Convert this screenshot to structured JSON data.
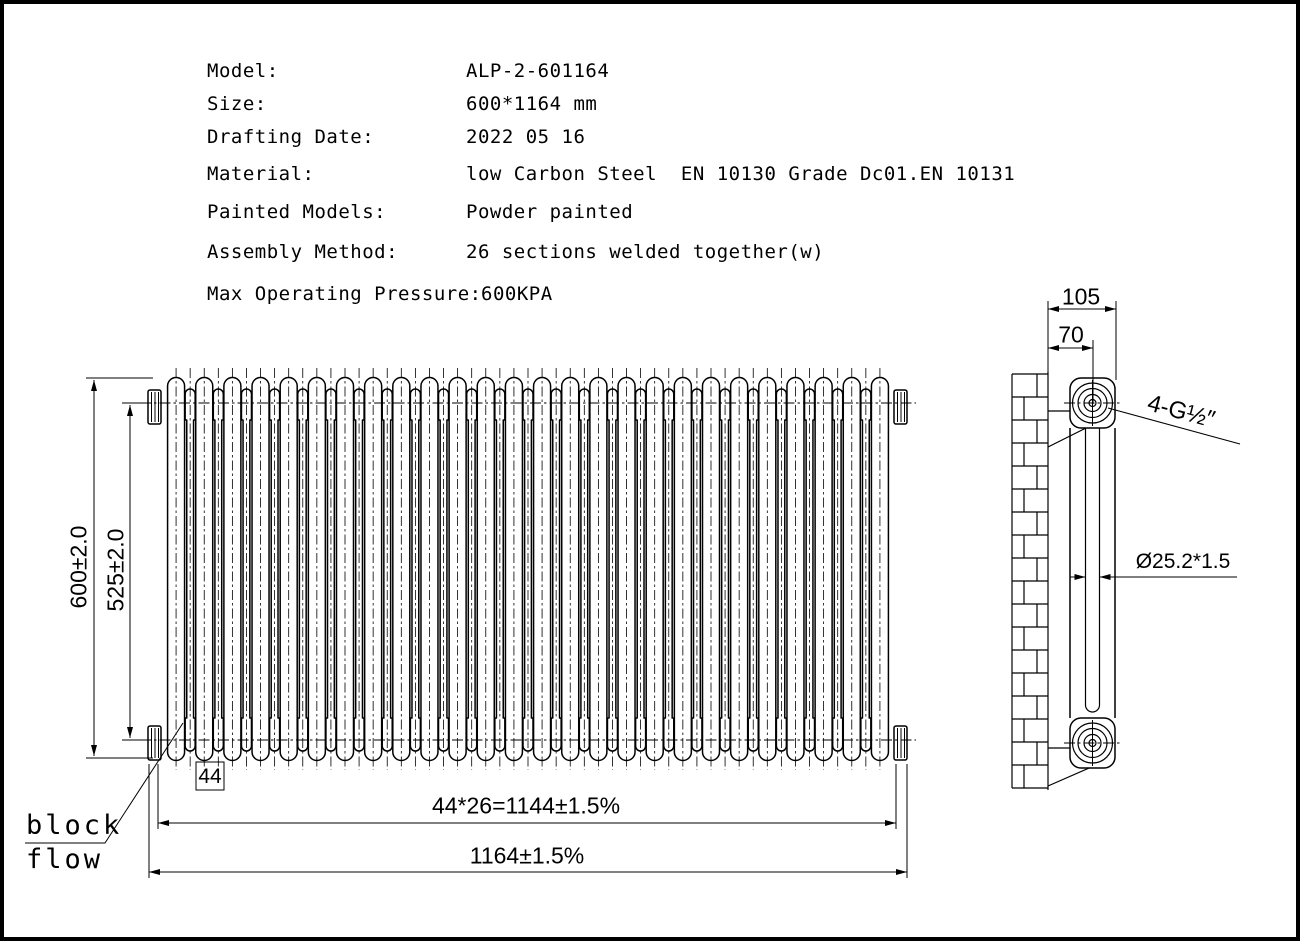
{
  "drawing": {
    "specs": [
      {
        "label": "Model:",
        "value": "ALP-2-601164"
      },
      {
        "label": "Size:",
        "value": "600*1164 mm"
      },
      {
        "label": "Drafting Date:",
        "value": "2022 05 16"
      },
      {
        "label": "Material:",
        "value": "low Carbon Steel  EN 10130 Grade Dc01.EN 10131"
      },
      {
        "label": "Painted Models:",
        "value": "Powder painted"
      },
      {
        "label": "Assembly Method:",
        "value": "26 sections welded together(w)"
      },
      {
        "label": "Max Operating Pressure:",
        "value": "600KPA"
      }
    ],
    "front_view": {
      "sections": 26,
      "dimensions": {
        "height_overall": "600±2.0",
        "height_centers": "525±2.0",
        "section_pitch": "44",
        "sections_total": "44*26=1144±1.5%",
        "length_overall": "1164±1.5%"
      },
      "labels": {
        "block": "block",
        "flow": "flow"
      }
    },
    "side_view": {
      "dimensions": {
        "depth_overall": "105",
        "wall_to_center": "70",
        "connections": "4-G½″",
        "tube": "Ø25.2*1.5"
      }
    },
    "colors": {
      "line": "#000000",
      "background": "#ffffff"
    }
  }
}
